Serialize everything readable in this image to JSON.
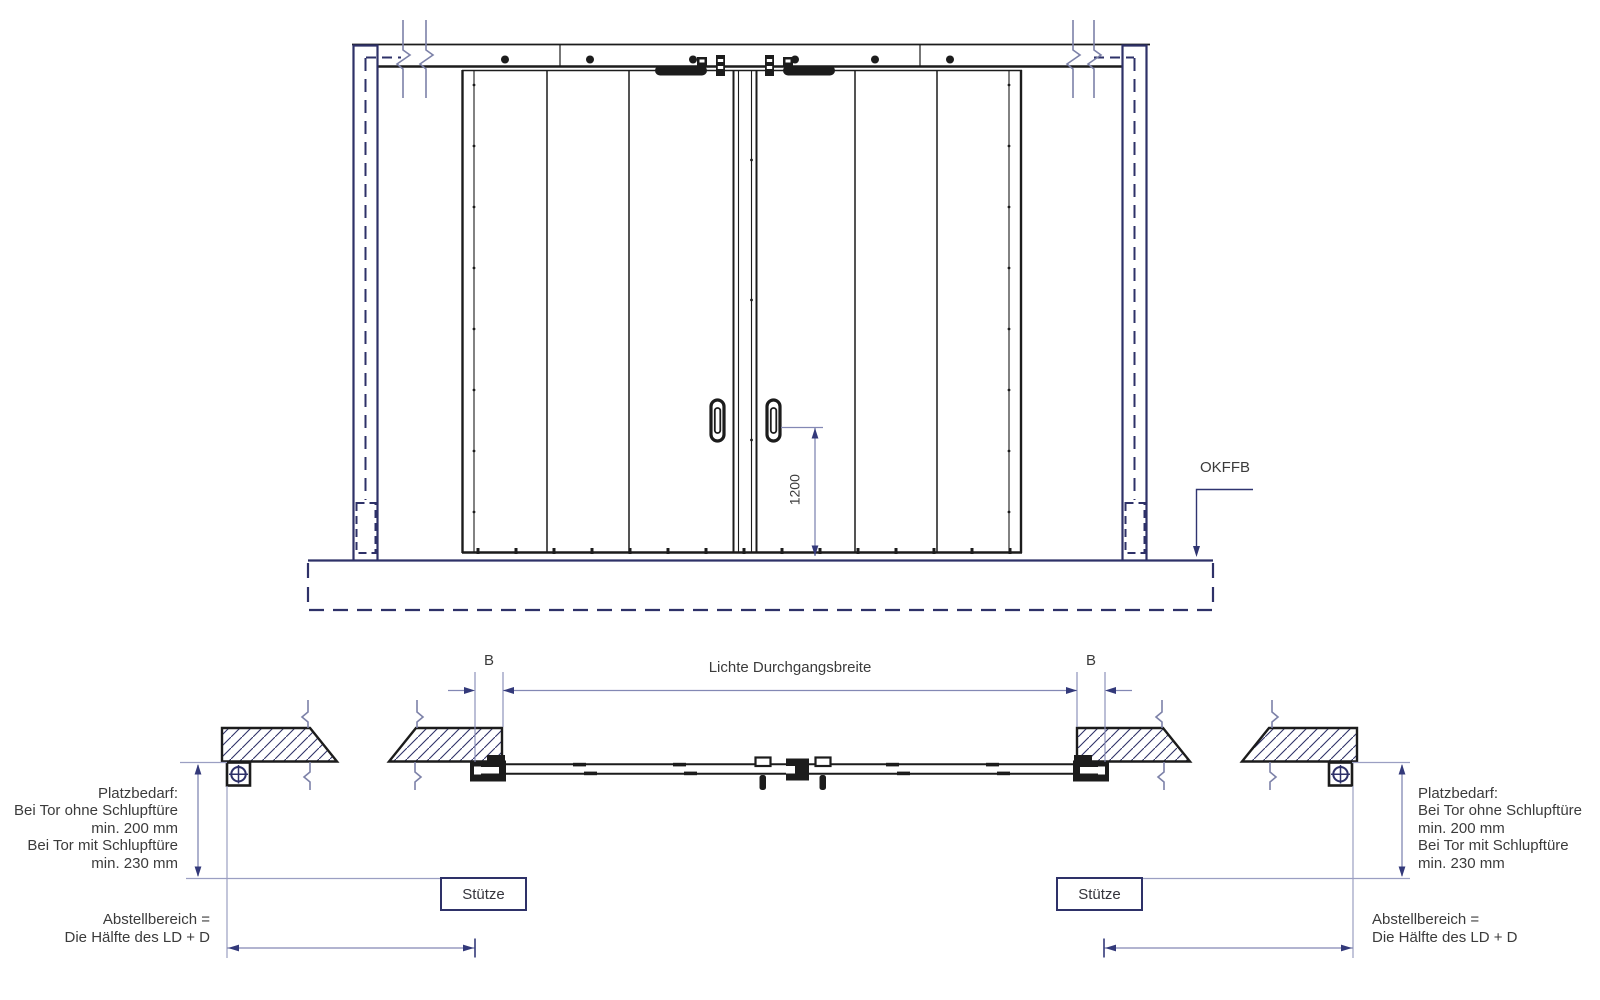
{
  "drawing_type": "sliding gate technical drawing (elevation and plan view)",
  "elevation": {
    "dim_height": "1200",
    "floor_label": "OKFFB"
  },
  "plan": {
    "dim_b_left": "B",
    "dim_b_right": "B",
    "clear_width_label": "Lichte Durchgangsbreite",
    "platzbedarf_lines": [
      "Platzbedarf:",
      "Bei Tor ohne Schlupftüre",
      "min. 200 mm",
      "Bei Tor mit Schlupftüre",
      "min. 230 mm"
    ],
    "stuetze_label": "Stütze",
    "abstellbereich_lines": [
      "Abstellbereich =",
      "Die Hälfte des LD + D"
    ]
  },
  "colors": {
    "line_black": "#1c1c1c",
    "structure_navy": "#2e3168",
    "break_line_blue": "#7c81a8",
    "dimension_blue": "#8388b4",
    "arrow_navy": "#33397a",
    "connector_gray_blue": "#9b9fc2",
    "text_gray": "#3b3b3b"
  }
}
